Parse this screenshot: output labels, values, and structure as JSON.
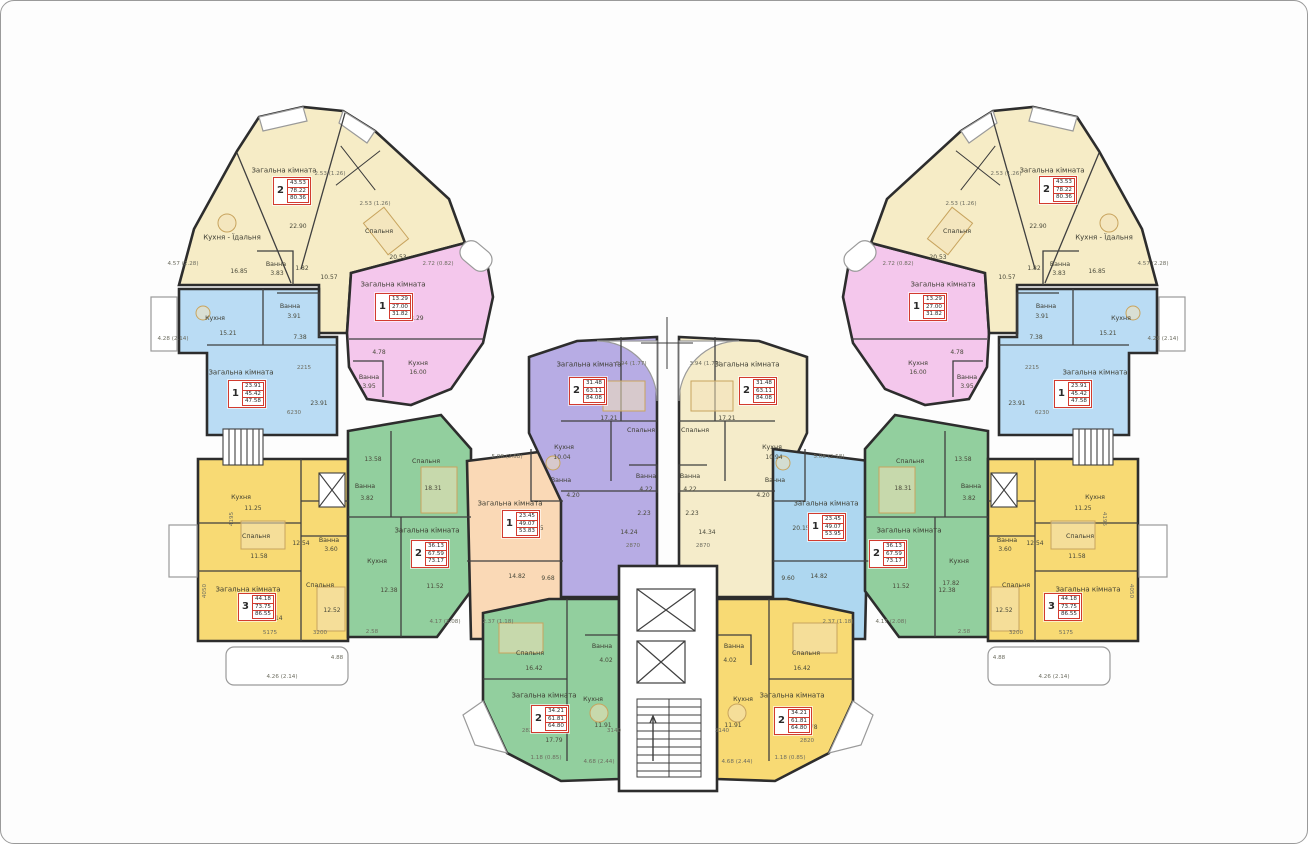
{
  "canvas": {
    "width": 1308,
    "height": 844
  },
  "colors": {
    "wing_yellow": "#f6ecc6",
    "pink": "#f4c7ec",
    "blue": "#badcf4",
    "slab_yellow": "#f8da74",
    "green": "#92cf9e",
    "orange": "#fad9b6",
    "purple": "#b7ace4",
    "center_yellow": "#f5ecca",
    "center_blue": "#aed7f0",
    "wall": "#2d2d2d",
    "red_box": "#d23b2f"
  },
  "apartments": [
    {
      "id": "wing-top-left-2r",
      "rooms": "2",
      "areas": [
        "43.53",
        "78.22",
        "80.36"
      ],
      "box": {
        "x": 272,
        "y": 176
      }
    },
    {
      "id": "left-pink-1r",
      "rooms": "1",
      "areas": [
        "13.29",
        "27.00",
        "31.82"
      ],
      "box": {
        "x": 374,
        "y": 292
      }
    },
    {
      "id": "left-blue-1r",
      "rooms": "1",
      "areas": [
        "23.91",
        "45.42",
        "47.58"
      ],
      "box": {
        "x": 227,
        "y": 379
      }
    },
    {
      "id": "left-yellow-3r",
      "rooms": "3",
      "areas": [
        "44.18",
        "73.75",
        "86.55"
      ],
      "box": {
        "x": 237,
        "y": 592
      }
    },
    {
      "id": "left-green-2r",
      "rooms": "2",
      "areas": [
        "36.13",
        "67.59",
        "73.17"
      ],
      "box": {
        "x": 410,
        "y": 539
      }
    },
    {
      "id": "center-orange-1r",
      "rooms": "1",
      "areas": [
        "23.45",
        "49.07",
        "53.83"
      ],
      "box": {
        "x": 501,
        "y": 509
      }
    },
    {
      "id": "center-purple-2r",
      "rooms": "2",
      "areas": [
        "31.48",
        "63.11",
        "84.08"
      ],
      "box": {
        "x": 568,
        "y": 376
      }
    },
    {
      "id": "center-yellow-2r",
      "rooms": "2",
      "areas": [
        "31.48",
        "63.11",
        "84.08"
      ],
      "box": {
        "x": 738,
        "y": 376
      }
    },
    {
      "id": "center-blue-1r",
      "rooms": "1",
      "areas": [
        "23.45",
        "49.07",
        "53.95"
      ],
      "box": {
        "x": 807,
        "y": 512
      }
    },
    {
      "id": "right-green-2r",
      "rooms": "2",
      "areas": [
        "36.13",
        "67.59",
        "73.17"
      ],
      "box": {
        "x": 868,
        "y": 539
      }
    },
    {
      "id": "right-pink-1r",
      "rooms": "1",
      "areas": [
        "13.29",
        "27.00",
        "31.82"
      ],
      "box": {
        "x": 908,
        "y": 292
      }
    },
    {
      "id": "right-blue-1r",
      "rooms": "1",
      "areas": [
        "23.91",
        "45.42",
        "47.58"
      ],
      "box": {
        "x": 1053,
        "y": 379
      }
    },
    {
      "id": "right-yellow-3r",
      "rooms": "3",
      "areas": [
        "44.18",
        "73.75",
        "86.55"
      ],
      "box": {
        "x": 1043,
        "y": 592
      }
    },
    {
      "id": "wing-top-right-2r",
      "rooms": "2",
      "areas": [
        "43.53",
        "78.22",
        "80.36"
      ],
      "box": {
        "x": 1038,
        "y": 175
      }
    },
    {
      "id": "bottom-green-2r",
      "rooms": "2",
      "areas": [
        "34.21",
        "61.81",
        "64.80"
      ],
      "box": {
        "x": 530,
        "y": 704
      }
    },
    {
      "id": "bottom-yellow-2r",
      "rooms": "2",
      "areas": [
        "34.21",
        "61.81",
        "64.80"
      ],
      "box": {
        "x": 773,
        "y": 706
      }
    }
  ],
  "labels": [
    {
      "x": 283,
      "y": 170,
      "t": "Загальна кімната",
      "c": "room"
    },
    {
      "x": 231,
      "y": 237,
      "t": "Кухня - Їдальня",
      "c": "room"
    },
    {
      "x": 378,
      "y": 231,
      "t": "Спальня",
      "c": "room-sm"
    },
    {
      "x": 238,
      "y": 271,
      "t": "16.85",
      "c": "area"
    },
    {
      "x": 275,
      "y": 264,
      "t": "Ванна",
      "c": "room-sm"
    },
    {
      "x": 276,
      "y": 273,
      "t": "3.83",
      "c": "area"
    },
    {
      "x": 397,
      "y": 257,
      "t": "20.53",
      "c": "area"
    },
    {
      "x": 301,
      "y": 268,
      "t": "1.82",
      "c": "area"
    },
    {
      "x": 328,
      "y": 277,
      "t": "10.57",
      "c": "area"
    },
    {
      "x": 329,
      "y": 174,
      "t": "2.53 (1.26)",
      "c": "dim"
    },
    {
      "x": 374,
      "y": 204,
      "t": "2.53 (1.26)",
      "c": "dim"
    },
    {
      "x": 297,
      "y": 226,
      "t": "22.90",
      "c": "area"
    },
    {
      "x": 437,
      "y": 264,
      "t": "2.72 (0.82)",
      "c": "dim"
    },
    {
      "x": 182,
      "y": 264,
      "t": "4.57 (2.28)",
      "c": "dim"
    },
    {
      "x": 392,
      "y": 284,
      "t": "Загальна кімната",
      "c": "room"
    },
    {
      "x": 417,
      "y": 363,
      "t": "Кухня",
      "c": "room-sm"
    },
    {
      "x": 417,
      "y": 372,
      "t": "16.00",
      "c": "area"
    },
    {
      "x": 368,
      "y": 377,
      "t": "Ванна",
      "c": "room-sm"
    },
    {
      "x": 368,
      "y": 386,
      "t": "3.95",
      "c": "area"
    },
    {
      "x": 414,
      "y": 318,
      "t": "18.29",
      "c": "area"
    },
    {
      "x": 378,
      "y": 352,
      "t": "4.78",
      "c": "area"
    },
    {
      "x": 214,
      "y": 318,
      "t": "Кухня",
      "c": "room-sm"
    },
    {
      "x": 227,
      "y": 333,
      "t": "15.21",
      "c": "area"
    },
    {
      "x": 289,
      "y": 306,
      "t": "Ванна",
      "c": "room-sm"
    },
    {
      "x": 293,
      "y": 316,
      "t": "3.91",
      "c": "area"
    },
    {
      "x": 240,
      "y": 372,
      "t": "Загальна кімната",
      "c": "room"
    },
    {
      "x": 318,
      "y": 403,
      "t": "23.91",
      "c": "area"
    },
    {
      "x": 293,
      "y": 413,
      "t": "6230",
      "c": "dim"
    },
    {
      "x": 303,
      "y": 368,
      "t": "2215",
      "c": "dim"
    },
    {
      "x": 299,
      "y": 337,
      "t": "7.38",
      "c": "area"
    },
    {
      "x": 172,
      "y": 339,
      "t": "4.28 (2.14)",
      "c": "dim"
    },
    {
      "x": 240,
      "y": 497,
      "t": "Кухня",
      "c": "room-sm"
    },
    {
      "x": 252,
      "y": 508,
      "t": "11.25",
      "c": "area"
    },
    {
      "x": 255,
      "y": 536,
      "t": "Спальня",
      "c": "room-sm"
    },
    {
      "x": 300,
      "y": 543,
      "t": "12.54",
      "c": "area"
    },
    {
      "x": 328,
      "y": 540,
      "t": "Ванна",
      "c": "room-sm"
    },
    {
      "x": 330,
      "y": 549,
      "t": "3.60",
      "c": "area"
    },
    {
      "x": 247,
      "y": 589,
      "t": "Загальна кімната",
      "c": "room"
    },
    {
      "x": 319,
      "y": 585,
      "t": "Спальня",
      "c": "room-sm"
    },
    {
      "x": 331,
      "y": 610,
      "t": "12.52",
      "c": "area"
    },
    {
      "x": 258,
      "y": 556,
      "t": "11.58",
      "c": "area"
    },
    {
      "x": 273,
      "y": 618,
      "t": "20.14",
      "c": "area"
    },
    {
      "x": 269,
      "y": 633,
      "t": "5175",
      "c": "dim"
    },
    {
      "x": 319,
      "y": 633,
      "t": "3200",
      "c": "dim"
    },
    {
      "x": 281,
      "y": 677,
      "t": "4.26 (2.14)",
      "c": "dim"
    },
    {
      "x": 336,
      "y": 658,
      "t": "4.88",
      "c": "dim"
    },
    {
      "x": 232,
      "y": 518,
      "t": "4195",
      "c": "dim",
      "r": -90
    },
    {
      "x": 205,
      "y": 590,
      "t": "4050",
      "c": "dim",
      "r": -90
    },
    {
      "x": 425,
      "y": 461,
      "t": "Спальня",
      "c": "room-sm"
    },
    {
      "x": 432,
      "y": 488,
      "t": "18.31",
      "c": "area"
    },
    {
      "x": 364,
      "y": 486,
      "t": "Ванна",
      "c": "room-sm"
    },
    {
      "x": 366,
      "y": 498,
      "t": "3.82",
      "c": "area"
    },
    {
      "x": 376,
      "y": 561,
      "t": "Кухня",
      "c": "room-sm"
    },
    {
      "x": 388,
      "y": 590,
      "t": "12.38",
      "c": "area"
    },
    {
      "x": 426,
      "y": 530,
      "t": "Загальна кімната",
      "c": "room"
    },
    {
      "x": 372,
      "y": 459,
      "t": "13.58",
      "c": "area"
    },
    {
      "x": 434,
      "y": 586,
      "t": "11.52",
      "c": "area"
    },
    {
      "x": 371,
      "y": 632,
      "t": "2.58",
      "c": "dim"
    },
    {
      "x": 444,
      "y": 622,
      "t": "4.17 (2.08)",
      "c": "dim"
    },
    {
      "x": 509,
      "y": 503,
      "t": "Загальна кімната",
      "c": "room"
    },
    {
      "x": 534,
      "y": 528,
      "t": "20.45",
      "c": "area"
    },
    {
      "x": 560,
      "y": 480,
      "t": "Ванна",
      "c": "room-sm"
    },
    {
      "x": 572,
      "y": 495,
      "t": "4.20",
      "c": "area"
    },
    {
      "x": 516,
      "y": 576,
      "t": "14.82",
      "c": "area"
    },
    {
      "x": 547,
      "y": 578,
      "t": "9.68",
      "c": "area"
    },
    {
      "x": 506,
      "y": 457,
      "t": "5.08 (2.58)",
      "c": "dim"
    },
    {
      "x": 497,
      "y": 622,
      "t": "2.37 (1.18)",
      "c": "dim"
    },
    {
      "x": 588,
      "y": 364,
      "t": "Загальна кімната",
      "c": "room"
    },
    {
      "x": 640,
      "y": 430,
      "t": "Спальня",
      "c": "room-sm"
    },
    {
      "x": 608,
      "y": 418,
      "t": "17.21",
      "c": "area"
    },
    {
      "x": 563,
      "y": 447,
      "t": "Кухня",
      "c": "room-sm"
    },
    {
      "x": 561,
      "y": 457,
      "t": "10.04",
      "c": "area"
    },
    {
      "x": 645,
      "y": 476,
      "t": "Ванна",
      "c": "room-sm"
    },
    {
      "x": 645,
      "y": 489,
      "t": "4.22",
      "c": "area"
    },
    {
      "x": 643,
      "y": 513,
      "t": "2.23",
      "c": "area"
    },
    {
      "x": 628,
      "y": 532,
      "t": "14.24",
      "c": "area"
    },
    {
      "x": 632,
      "y": 546,
      "t": "2870",
      "c": "dim"
    },
    {
      "x": 630,
      "y": 364,
      "t": "3.94 (1.77)",
      "c": "dim"
    },
    {
      "x": 746,
      "y": 364,
      "t": "Загальна кімната",
      "c": "room"
    },
    {
      "x": 694,
      "y": 430,
      "t": "Спальня",
      "c": "room-sm"
    },
    {
      "x": 726,
      "y": 418,
      "t": "17.21",
      "c": "area"
    },
    {
      "x": 771,
      "y": 447,
      "t": "Кухня",
      "c": "room-sm"
    },
    {
      "x": 773,
      "y": 457,
      "t": "10.94",
      "c": "area"
    },
    {
      "x": 689,
      "y": 476,
      "t": "Ванна",
      "c": "room-sm"
    },
    {
      "x": 689,
      "y": 489,
      "t": "4.22",
      "c": "area"
    },
    {
      "x": 691,
      "y": 513,
      "t": "2.23",
      "c": "area"
    },
    {
      "x": 706,
      "y": 532,
      "t": "14.34",
      "c": "area"
    },
    {
      "x": 702,
      "y": 546,
      "t": "2870",
      "c": "dim"
    },
    {
      "x": 704,
      "y": 364,
      "t": "3.94 (1.77)",
      "c": "dim"
    },
    {
      "x": 825,
      "y": 503,
      "t": "Загальна кімната",
      "c": "room"
    },
    {
      "x": 800,
      "y": 528,
      "t": "20.15",
      "c": "area"
    },
    {
      "x": 774,
      "y": 480,
      "t": "Ванна",
      "c": "room-sm"
    },
    {
      "x": 762,
      "y": 495,
      "t": "4.20",
      "c": "area"
    },
    {
      "x": 818,
      "y": 576,
      "t": "14.82",
      "c": "area"
    },
    {
      "x": 787,
      "y": 578,
      "t": "9.60",
      "c": "area"
    },
    {
      "x": 828,
      "y": 457,
      "t": "5.08 (2.58)",
      "c": "dim"
    },
    {
      "x": 837,
      "y": 622,
      "t": "2.37 (1.18)",
      "c": "dim"
    },
    {
      "x": 909,
      "y": 461,
      "t": "Спальня",
      "c": "room-sm"
    },
    {
      "x": 902,
      "y": 488,
      "t": "18.31",
      "c": "area"
    },
    {
      "x": 970,
      "y": 486,
      "t": "Ванна",
      "c": "room-sm"
    },
    {
      "x": 968,
      "y": 498,
      "t": "3.82",
      "c": "area"
    },
    {
      "x": 958,
      "y": 561,
      "t": "Кухня",
      "c": "room-sm"
    },
    {
      "x": 946,
      "y": 590,
      "t": "12.38",
      "c": "area"
    },
    {
      "x": 908,
      "y": 530,
      "t": "Загальна кімната",
      "c": "room"
    },
    {
      "x": 962,
      "y": 459,
      "t": "13.58",
      "c": "area"
    },
    {
      "x": 900,
      "y": 586,
      "t": "11.52",
      "c": "area"
    },
    {
      "x": 950,
      "y": 583,
      "t": "17.82",
      "c": "area"
    },
    {
      "x": 890,
      "y": 622,
      "t": "4.17 (2.08)",
      "c": "dim"
    },
    {
      "x": 963,
      "y": 632,
      "t": "2.58",
      "c": "dim"
    },
    {
      "x": 942,
      "y": 284,
      "t": "Загальна кімната",
      "c": "room"
    },
    {
      "x": 917,
      "y": 363,
      "t": "Кухня",
      "c": "room-sm"
    },
    {
      "x": 917,
      "y": 372,
      "t": "16.00",
      "c": "area"
    },
    {
      "x": 966,
      "y": 377,
      "t": "Ванна",
      "c": "room-sm"
    },
    {
      "x": 966,
      "y": 386,
      "t": "3.95",
      "c": "area"
    },
    {
      "x": 920,
      "y": 318,
      "t": "18.29",
      "c": "area"
    },
    {
      "x": 956,
      "y": 352,
      "t": "4.78",
      "c": "area"
    },
    {
      "x": 1120,
      "y": 318,
      "t": "Кухня",
      "c": "room-sm"
    },
    {
      "x": 1107,
      "y": 333,
      "t": "15.21",
      "c": "area"
    },
    {
      "x": 1045,
      "y": 306,
      "t": "Ванна",
      "c": "room-sm"
    },
    {
      "x": 1041,
      "y": 316,
      "t": "3.91",
      "c": "area"
    },
    {
      "x": 1094,
      "y": 372,
      "t": "Загальна кімната",
      "c": "room"
    },
    {
      "x": 1016,
      "y": 403,
      "t": "23.91",
      "c": "area"
    },
    {
      "x": 1041,
      "y": 413,
      "t": "6230",
      "c": "dim"
    },
    {
      "x": 1031,
      "y": 368,
      "t": "2215",
      "c": "dim"
    },
    {
      "x": 1035,
      "y": 337,
      "t": "7.38",
      "c": "area"
    },
    {
      "x": 1162,
      "y": 339,
      "t": "4.28 (2.14)",
      "c": "dim"
    },
    {
      "x": 1094,
      "y": 497,
      "t": "Кухня",
      "c": "room-sm"
    },
    {
      "x": 1082,
      "y": 508,
      "t": "11.25",
      "c": "area"
    },
    {
      "x": 1079,
      "y": 536,
      "t": "Спальня",
      "c": "room-sm"
    },
    {
      "x": 1034,
      "y": 543,
      "t": "12.54",
      "c": "area"
    },
    {
      "x": 1006,
      "y": 540,
      "t": "Ванна",
      "c": "room-sm"
    },
    {
      "x": 1004,
      "y": 549,
      "t": "3.60",
      "c": "area"
    },
    {
      "x": 1087,
      "y": 589,
      "t": "Загальна кімната",
      "c": "room"
    },
    {
      "x": 1015,
      "y": 585,
      "t": "Спальня",
      "c": "room-sm"
    },
    {
      "x": 1003,
      "y": 610,
      "t": "12.52",
      "c": "area"
    },
    {
      "x": 1076,
      "y": 556,
      "t": "11.58",
      "c": "area"
    },
    {
      "x": 1061,
      "y": 618,
      "t": "20.14",
      "c": "area"
    },
    {
      "x": 1065,
      "y": 633,
      "t": "5175",
      "c": "dim"
    },
    {
      "x": 1015,
      "y": 633,
      "t": "3200",
      "c": "dim"
    },
    {
      "x": 1053,
      "y": 677,
      "t": "4.26 (2.14)",
      "c": "dim"
    },
    {
      "x": 998,
      "y": 658,
      "t": "4.88",
      "c": "dim"
    },
    {
      "x": 1102,
      "y": 518,
      "t": "4195",
      "c": "dim",
      "r": 90
    },
    {
      "x": 1129,
      "y": 590,
      "t": "4050",
      "c": "dim",
      "r": 90
    },
    {
      "x": 1051,
      "y": 170,
      "t": "Загальна кімната",
      "c": "room"
    },
    {
      "x": 1103,
      "y": 237,
      "t": "Кухня - Їдальня",
      "c": "room"
    },
    {
      "x": 956,
      "y": 231,
      "t": "Спальня",
      "c": "room-sm"
    },
    {
      "x": 1096,
      "y": 271,
      "t": "16.85",
      "c": "area"
    },
    {
      "x": 1059,
      "y": 264,
      "t": "Ванна",
      "c": "room-sm"
    },
    {
      "x": 1058,
      "y": 273,
      "t": "3.83",
      "c": "area"
    },
    {
      "x": 937,
      "y": 257,
      "t": "20.53",
      "c": "area"
    },
    {
      "x": 1033,
      "y": 268,
      "t": "1.82",
      "c": "area"
    },
    {
      "x": 1006,
      "y": 277,
      "t": "10.57",
      "c": "area"
    },
    {
      "x": 1005,
      "y": 174,
      "t": "2.53 (1.26)",
      "c": "dim"
    },
    {
      "x": 960,
      "y": 204,
      "t": "2.53 (1.26)",
      "c": "dim"
    },
    {
      "x": 1037,
      "y": 226,
      "t": "22.90",
      "c": "area"
    },
    {
      "x": 897,
      "y": 264,
      "t": "2.72 (0.82)",
      "c": "dim"
    },
    {
      "x": 1152,
      "y": 264,
      "t": "4.57 (2.28)",
      "c": "dim"
    },
    {
      "x": 529,
      "y": 653,
      "t": "Спальня",
      "c": "room-sm"
    },
    {
      "x": 533,
      "y": 668,
      "t": "16.42",
      "c": "area"
    },
    {
      "x": 601,
      "y": 646,
      "t": "Ванна",
      "c": "room-sm"
    },
    {
      "x": 605,
      "y": 660,
      "t": "4.02",
      "c": "area"
    },
    {
      "x": 592,
      "y": 699,
      "t": "Кухня",
      "c": "room-sm"
    },
    {
      "x": 602,
      "y": 725,
      "t": "11.91",
      "c": "area"
    },
    {
      "x": 543,
      "y": 695,
      "t": "Загальна кімната",
      "c": "room"
    },
    {
      "x": 553,
      "y": 740,
      "t": "17.79",
      "c": "area"
    },
    {
      "x": 545,
      "y": 758,
      "t": "1.18 (0.85)",
      "c": "dim"
    },
    {
      "x": 598,
      "y": 762,
      "t": "4.68 (2.44)",
      "c": "dim"
    },
    {
      "x": 528,
      "y": 731,
      "t": "2820",
      "c": "dim"
    },
    {
      "x": 613,
      "y": 731,
      "t": "3140",
      "c": "dim"
    },
    {
      "x": 805,
      "y": 653,
      "t": "Спальня",
      "c": "room-sm"
    },
    {
      "x": 801,
      "y": 668,
      "t": "16.42",
      "c": "area"
    },
    {
      "x": 733,
      "y": 646,
      "t": "Ванна",
      "c": "room-sm"
    },
    {
      "x": 729,
      "y": 660,
      "t": "4.02",
      "c": "area"
    },
    {
      "x": 742,
      "y": 699,
      "t": "Кухня",
      "c": "room-sm"
    },
    {
      "x": 732,
      "y": 725,
      "t": "11.91",
      "c": "area"
    },
    {
      "x": 791,
      "y": 695,
      "t": "Загальна кімната",
      "c": "room"
    },
    {
      "x": 808,
      "y": 727,
      "t": "17.78",
      "c": "area"
    },
    {
      "x": 789,
      "y": 758,
      "t": "1.18 (0.85)",
      "c": "dim"
    },
    {
      "x": 736,
      "y": 762,
      "t": "4.68 (2.44)",
      "c": "dim"
    },
    {
      "x": 806,
      "y": 741,
      "t": "2820",
      "c": "dim"
    },
    {
      "x": 721,
      "y": 731,
      "t": "3140",
      "c": "dim"
    }
  ]
}
